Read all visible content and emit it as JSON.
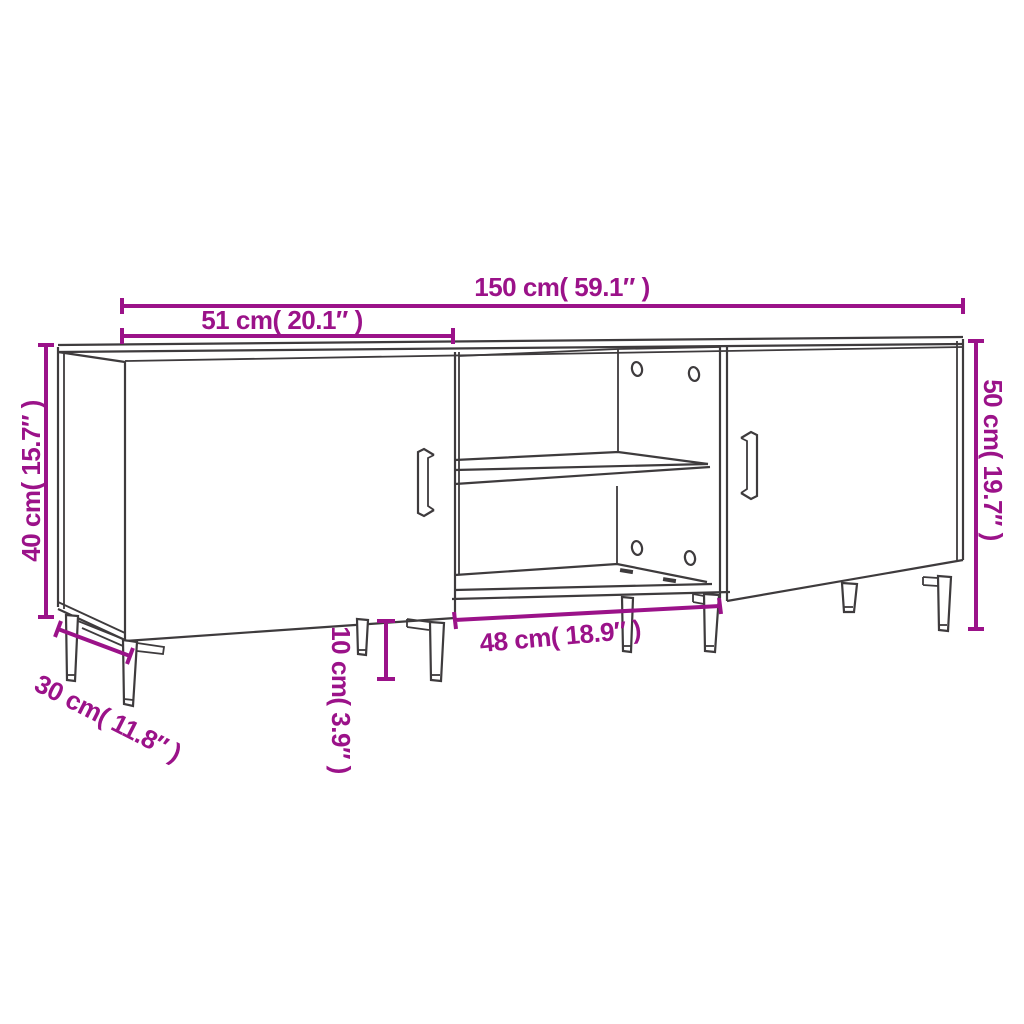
{
  "diagram": {
    "title": "TV cabinet dimension diagram",
    "colors": {
      "dimension_color": "#9b1289",
      "drawing_line_color": "#3e3b3d",
      "background": "#ffffff"
    },
    "dimensions": {
      "overall_width": {
        "label": "150 cm( 59.1″ )",
        "cm": 150,
        "inches": 59.1
      },
      "left_section_width": {
        "label": "51 cm( 20.1″ )",
        "cm": 51,
        "inches": 20.1
      },
      "left_body_height": {
        "label": "40 cm( 15.7″ )",
        "cm": 40,
        "inches": 15.7
      },
      "overall_height": {
        "label": "50 cm( 19.7″ )",
        "cm": 50,
        "inches": 19.7
      },
      "middle_compartment_width": {
        "label": "48 cm( 18.9″ )",
        "cm": 48,
        "inches": 18.9
      },
      "leg_height": {
        "label": "10 cm( 3.9″ )",
        "cm": 10,
        "inches": 3.9
      },
      "depth": {
        "label": "30 cm( 11.8″ )",
        "cm": 30,
        "inches": 11.8
      }
    }
  }
}
